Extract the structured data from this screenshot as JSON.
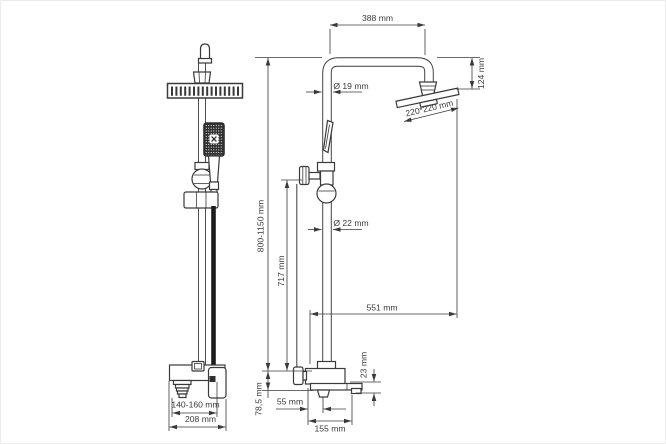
{
  "drawing": {
    "type": "shower-system-technical-drawing",
    "views": [
      "front-view",
      "side-view"
    ],
    "colors": {
      "background": "#ffffff",
      "line": "#3a3a3a",
      "dark_fill": "#2e2e2e"
    }
  },
  "labels": {
    "width_top": "388 mm",
    "head_offset": "124 mm",
    "head_size": "220*220 mm",
    "pipe_top_diameter": "Ø 19 mm",
    "height_range": "800-1150 mm",
    "riser_height": "717 mm",
    "pipe_diameter": "Ø 22 mm",
    "reach": "551 mm",
    "spout_drop": "23 mm",
    "wall_offset": "78,5 mm",
    "spout_offset": "55 mm",
    "mixer_depth": "155 mm",
    "inlet_spacing": "140-160 mm",
    "mixer_width": "208 mm"
  }
}
